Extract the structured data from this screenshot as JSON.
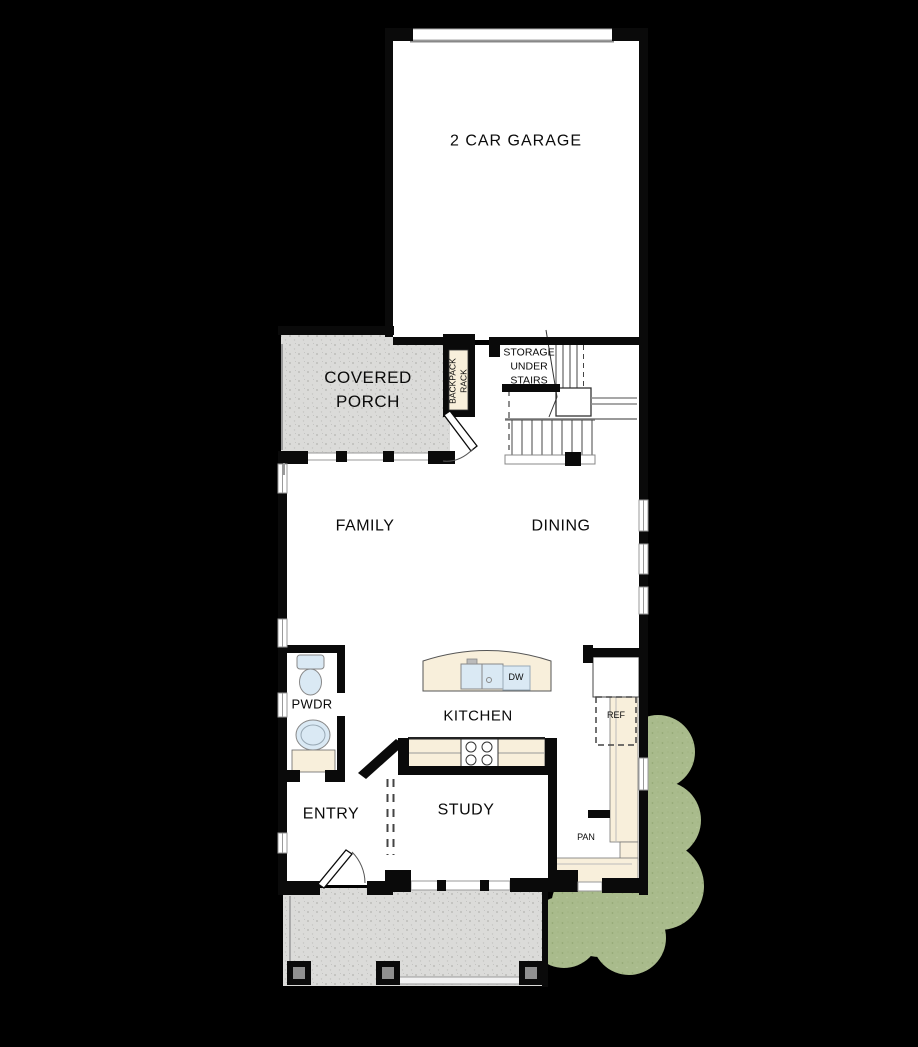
{
  "plan": {
    "type": "first-floor-plan",
    "colors": {
      "wall": "#0a0a0a",
      "floor": "#ffffff",
      "porch_concrete": "#dbdbd9",
      "counter": "#f8efdb",
      "fixture": "#dae9f4",
      "landscape": "#a9bb8c",
      "background": "#000000"
    }
  },
  "rooms": {
    "garage": {
      "label": "2 CAR GARAGE"
    },
    "covered_porch": {
      "label": "COVERED PORCH"
    },
    "storage": {
      "label": "STORAGE UNDER STAIRS"
    },
    "backpack_rack": {
      "label": "BACKPACK RACK"
    },
    "family": {
      "label": "FAMILY"
    },
    "dining": {
      "label": "DINING"
    },
    "pwdr": {
      "label": "PWDR"
    },
    "kitchen": {
      "label": "KITCHEN"
    },
    "entry": {
      "label": "ENTRY"
    },
    "study": {
      "label": "STUDY"
    },
    "pantry": {
      "label": "PAN"
    }
  },
  "appliances": {
    "dishwasher": {
      "label": "DW"
    },
    "refrigerator": {
      "label": "REF"
    }
  }
}
